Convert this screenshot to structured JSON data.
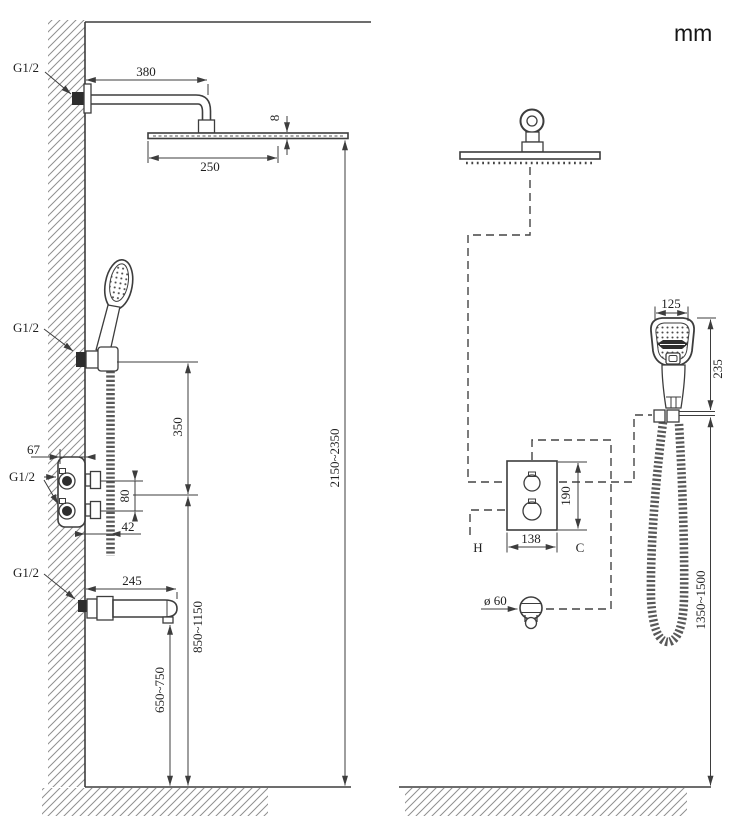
{
  "diagram": {
    "unit": "mm",
    "colors": {
      "line": "#3d3d3d",
      "background": "#ffffff"
    },
    "left": {
      "g_arm": "G1/2",
      "g_hand": "G1/2",
      "g_valve": "G1/2",
      "g_spout": "G1/2",
      "arm_length": "380",
      "head_width": "250",
      "head_thickness": "8",
      "hand_to_valve": "350",
      "valve_depth": "67",
      "knob_spacing": "80",
      "valve_offset": "42",
      "spout_length": "245",
      "spout_height": "650~750",
      "valve_height": "850~1150",
      "head_height": "2150~2350"
    },
    "right": {
      "hand_width": "125",
      "hand_height": "235",
      "valve_width": "138",
      "valve_height": "190",
      "hot_label": "H",
      "cold_label": "C",
      "outlet_diameter": "ø 60",
      "hose_height": "1350~1500"
    }
  }
}
